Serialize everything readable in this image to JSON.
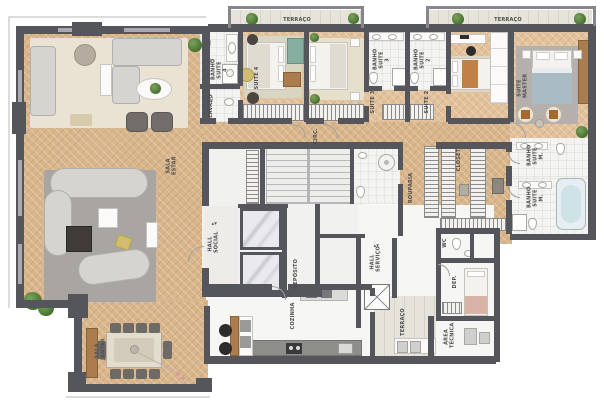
{
  "colors": {
    "wall": "#55555c",
    "wallL": "#a9a9af",
    "rail": "#86868c",
    "wood": "#d9b58c",
    "woodL": "#e2c29c",
    "bath": "#f3f3f1",
    "terr": "#e6e3da",
    "core": "#f1f1ef",
    "rugC": "#eae3d3",
    "rugG": "#a8a5a2",
    "sofa": "#d6d4d0",
    "fwood": "#aa7c4e",
    "counter": "#8e8e8b",
    "marble": "#eaeaee",
    "teal": "#85ada0",
    "yellow": "#d2bc6d",
    "green": "#4f7d3c",
    "tub": "#cfe2e8",
    "dark": "#3e3b38"
  },
  "labels": {
    "terraco_1": "TERRAÇO",
    "terraco_2": "TERRAÇO",
    "sala_estar": "SALA ESTAR",
    "sala_jantar": "SALA JANTAR",
    "banho_suite_4": "BANHO SUITE 4",
    "lavabo": "LAVABO",
    "suite_4": "SUITE 4",
    "banho_suite_3": "BANHO SUITE 3",
    "banho_suite_2": "BANHO SUITE 2",
    "suite_3": "SUITE 3",
    "suite_2": "SUITE 2",
    "suite_master": "SUITE MASTER",
    "circ": "CIRC.",
    "rouparia": "ROUPARIA",
    "closet": "CLOSET",
    "banho_suite_m1": "BANHO SUITE M.",
    "banho_suite_m2": "BANHO SUITE M.",
    "hall_social": "HALL SOCIAL",
    "deposito": "DEPÓSITO",
    "hall_servico": "HALL SERVIÇO",
    "cozinha": "COZINHA",
    "terraco_servico": "TERRAÇO",
    "wc": "WC",
    "dep": "DEP.",
    "area_tecnica": "ÁREA TÉCNICA"
  },
  "icons": {
    "elevator_call": "▲▼"
  }
}
